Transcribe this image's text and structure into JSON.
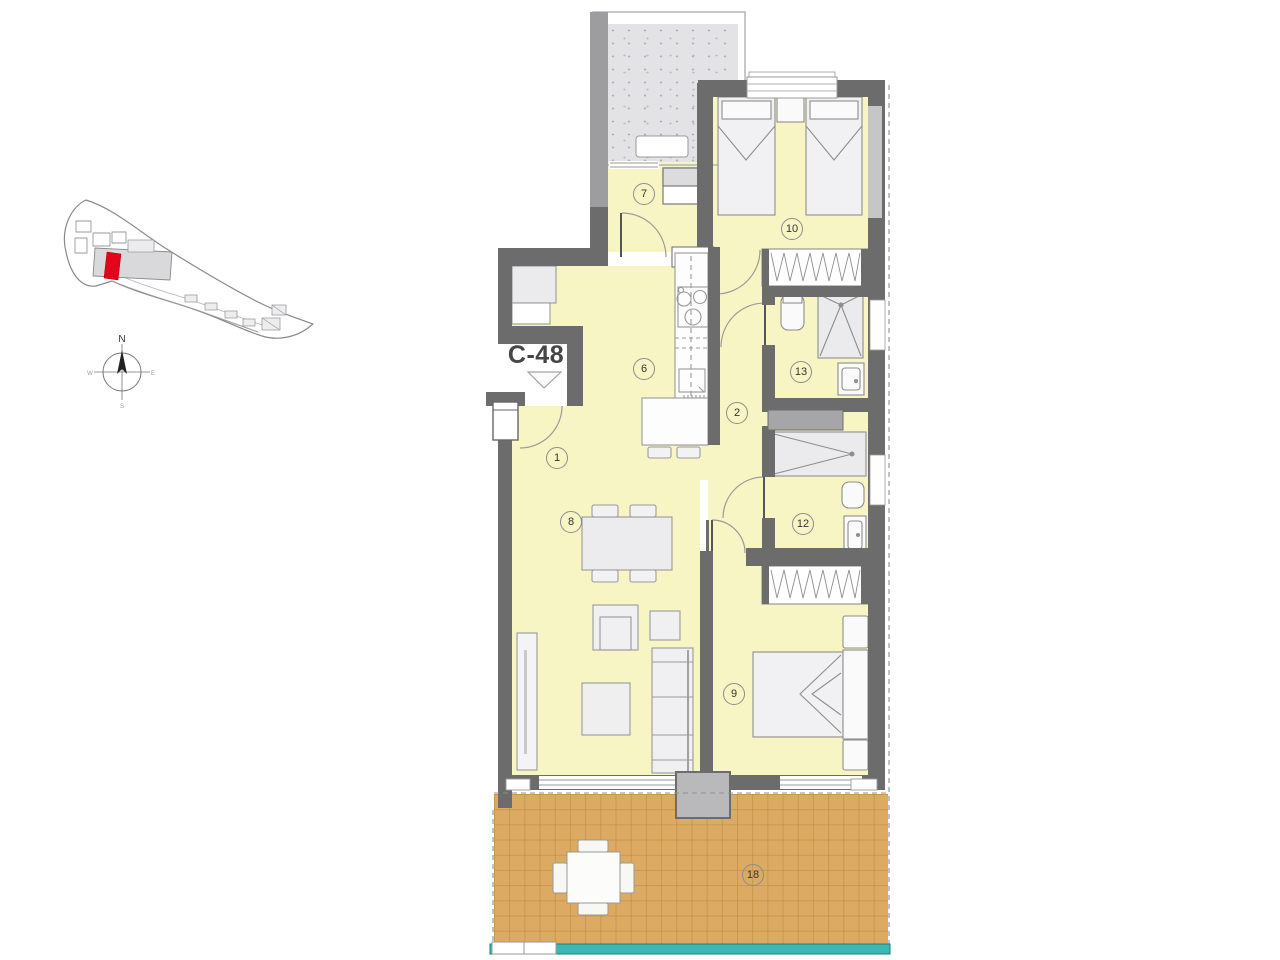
{
  "plan": {
    "unit_label": "C-48",
    "compass": {
      "n": "N",
      "e": "E",
      "s": "S",
      "w": "W"
    },
    "room_badges": [
      {
        "number": "1"
      },
      {
        "number": "2"
      },
      {
        "number": "6"
      },
      {
        "number": "7"
      },
      {
        "number": "8"
      },
      {
        "number": "9"
      },
      {
        "number": "10"
      },
      {
        "number": "12"
      },
      {
        "number": "13"
      },
      {
        "number": "18"
      }
    ],
    "colors": {
      "wall": "#6c6c6c",
      "floor": "#f8f5c4",
      "terrace": "#dcaa62",
      "patio": "#e3e3e6",
      "glass_balustrade": "#3cb7b2",
      "unit_marker": "#e1061b"
    }
  }
}
